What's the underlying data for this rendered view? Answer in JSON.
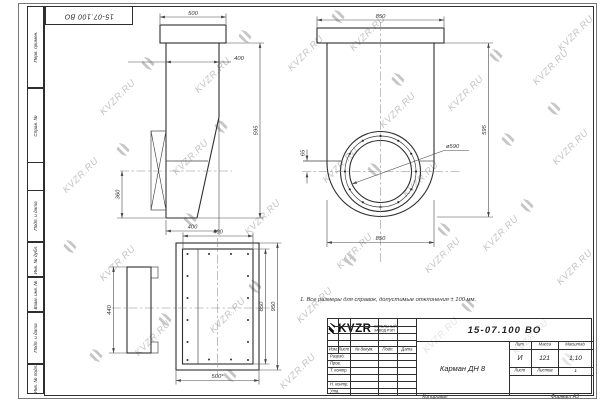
{
  "watermark": {
    "text": "KVZR.RU"
  },
  "stamp": {
    "top_doc_number": "15-07.100 ВО"
  },
  "margin_labels": [
    "Перв. примен.",
    "Справ. №",
    "Подп. и дата",
    "Инв. № дубл.",
    "Взам. инв. №",
    "Подп. и дата",
    "Инв. № подл."
  ],
  "dims": {
    "side": {
      "flange_width": "500",
      "body_width": "400",
      "height": "595",
      "branch_offset": "360",
      "bottom_width": "400"
    },
    "front": {
      "flange_width": "850",
      "height": "595",
      "body_width": "850",
      "offset": "65",
      "diameter": "ø590"
    },
    "flange": {
      "opening_width": "400",
      "branch_height": "440",
      "opening_height": "850",
      "plate_height": "950",
      "plate_width": "500*"
    }
  },
  "note": "1. Все размеры для справок, допустимые отклонения ± 100 мм.",
  "title_block": {
    "doc_number": "15-07.100 ВО",
    "part_name": "Карман ДН 8",
    "col_izm": "Изм.",
    "col_list": "Лист",
    "col_doc": "№ докум.",
    "col_sign": "Подп.",
    "col_date": "Дата",
    "row_developed": "Разраб.",
    "row_checked": "Пров.",
    "row_tcontrol": "Т. контр.",
    "row_ncontrol": "Н. контр.",
    "row_approved": "Утв.",
    "lit_label": "Лит.",
    "mass_label": "Масса",
    "scale_label": "Масштаб",
    "lit_value": "И",
    "mass_value": "121",
    "scale_value": "1:10",
    "sheet_label": "Лист",
    "sheets_label": "Листов",
    "sheets_value": "1",
    "brand": "KVZR",
    "brand_line1": "КОТЕЛЬНЫЙ",
    "brand_line2": "ЗАВОД РЭП",
    "copied": "Копировал",
    "format": "Формат А3"
  }
}
